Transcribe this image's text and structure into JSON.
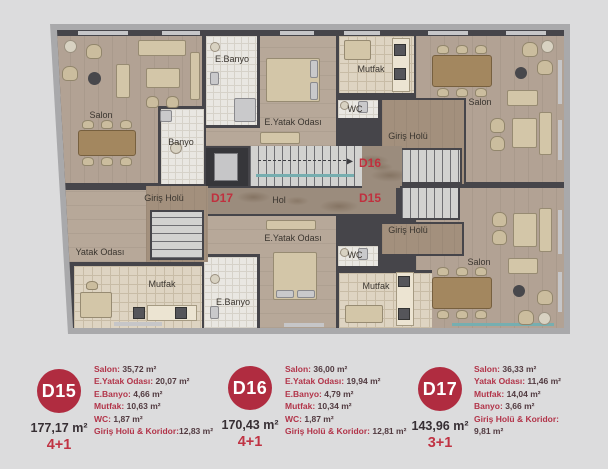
{
  "plan": {
    "rooms": {
      "salon_d17": "Salon",
      "banyo_d17": "Banyo",
      "giris_d17": "Giriş Holü",
      "yatak_d17": "Yatak Odası",
      "mutfak_d17": "Mutfak",
      "e_banyo_d16": "E.Banyo",
      "e_yatak_d16": "E.Yatak Odası",
      "mutfak_d16": "Mutfak",
      "wc_d16": "WC",
      "giris_d16": "Giriş Holü",
      "salon_d16": "Salon",
      "hol": "Hol",
      "e_banyo_d15": "E.Banyo",
      "e_yatak_d15": "E.Yatak Odası",
      "wc_d15": "WC",
      "mutfak_d15": "Mutfak",
      "giris_d15": "Giriş Holü",
      "salon_d15": "Salon"
    },
    "tags": {
      "d15": "D15",
      "d16": "D16",
      "d17": "D17"
    }
  },
  "legend": {
    "units": [
      {
        "id": "D15",
        "area": "177,17 m²",
        "type": "4+1",
        "rooms": [
          {
            "label": "Salon:",
            "value": "35,72 m²"
          },
          {
            "label": "E.Yatak Odası:",
            "value": "20,07 m²"
          },
          {
            "label": "E.Banyo:",
            "value": "4,66 m²"
          },
          {
            "label": "Mutfak:",
            "value": "10,63 m²"
          },
          {
            "label": "WC:",
            "value": "1,87 m²"
          },
          {
            "label": "Giriş Holü & Koridor:",
            "value": "12,83 m²"
          }
        ]
      },
      {
        "id": "D16",
        "area": "170,43 m²",
        "type": "4+1",
        "rooms": [
          {
            "label": "Salon:",
            "value": "36,00 m²"
          },
          {
            "label": "E.Yatak Odası:",
            "value": "19,94 m²"
          },
          {
            "label": "E.Banyo:",
            "value": "4,79 m²"
          },
          {
            "label": "Mutfak:",
            "value": "10,34 m²"
          },
          {
            "label": "WC:",
            "value": "1,87 m²"
          },
          {
            "label": "Giriş Holü & Koridor:",
            "value": "12,81 m²"
          }
        ]
      },
      {
        "id": "D17",
        "area": "143,96 m²",
        "type": "3+1",
        "rooms": [
          {
            "label": "Salon:",
            "value": "36,33 m²"
          },
          {
            "label": "Yatak Odası:",
            "value": "11,46 m²"
          },
          {
            "label": "Mutfak:",
            "value": "14,04 m²"
          },
          {
            "label": "Banyo:",
            "value": "3,66 m²"
          },
          {
            "label": "Giriş Holü & Koridor:",
            "value": "9,81 m²"
          }
        ]
      }
    ]
  },
  "colors": {
    "accent_red": "#b02c40",
    "plan_tag_red": "#c0303e",
    "legend_label_red": "#b23449",
    "legend_value_dark": "#513a40",
    "background": "#dcdcdd",
    "wall": "#46454a"
  }
}
